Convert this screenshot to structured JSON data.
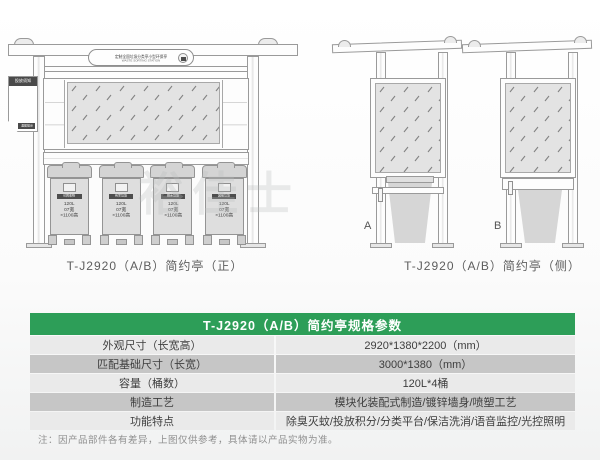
{
  "front": {
    "plaque_line1": "定制全国垃圾分类亭小型环保亭",
    "plaque_line2": "WASTE SORTING STATION",
    "notice_top": "投放须知",
    "notice_bottom": "温馨提示",
    "caption": "T-J2920（A/B）简约亭（正）",
    "bin_categories": [
      "可回收物",
      "有害垃圾",
      "厨余垃圾",
      "其他垃圾"
    ],
    "bin_specs": [
      "120L",
      "07宽",
      "×1100高"
    ]
  },
  "side": {
    "caption": "T-J2920（A/B）简约亭（侧）",
    "label_a": "A",
    "label_b": "B"
  },
  "watermark": "裕佳士",
  "table": {
    "title": "T-J2920（A/B）简约亭规格参数",
    "rows": [
      {
        "label": "外观尺寸（长宽高）",
        "value": "2920*1380*2200（mm）"
      },
      {
        "label": "匹配基础尺寸（长宽）",
        "value": "3000*1380（mm）"
      },
      {
        "label": "容量（桶数）",
        "value": "120L*4桶"
      },
      {
        "label": "制造工艺",
        "value": "模块化装配式制造/镀锌墙身/喷塑工艺"
      },
      {
        "label": "功能特点",
        "value": "除臭灭蚊/投放积分/分类平台/保洁洗消/语音监控/光控照明"
      }
    ],
    "footnote": "注：因产品部件各有差异，上图仅供参考，具体请以产品实物为准。"
  },
  "colors": {
    "accent_green": "#2d9e58",
    "row_light": "#eaeaea",
    "row_dark": "#c6c6c6"
  }
}
